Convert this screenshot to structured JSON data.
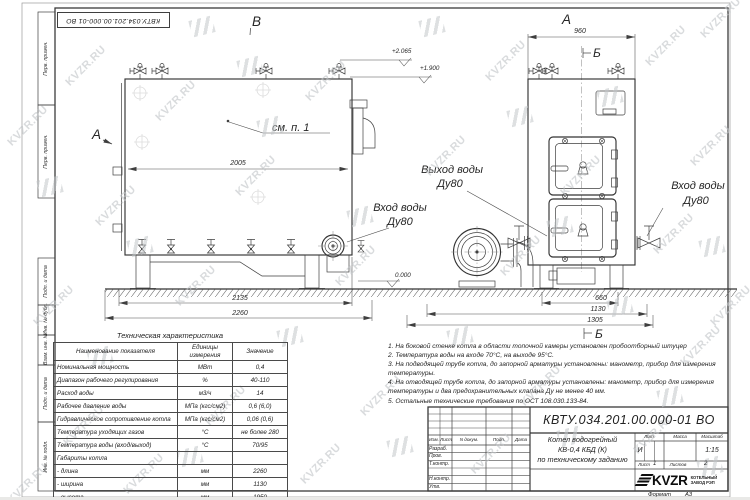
{
  "watermark": {
    "text": "KVZR.RU"
  },
  "frame": {
    "top_stamp": "КВТУ.034.201.00.000-01 ВО",
    "left_top_labels": [
      "Перв. примен.",
      "Перв. примен."
    ],
    "left_bottom_labels": [
      "Подп. и дата",
      "Инв. № дубл.",
      "Взам. инв. №",
      "Подп. и дата",
      "Инв. № подл."
    ],
    "format_label": "Формат",
    "format_value": "А3"
  },
  "drawing": {
    "markers": {
      "a_left": "А",
      "b_top": "В",
      "a_front": "А",
      "b_front": "Б",
      "b_bottom": "Б"
    },
    "callout_note": "см. п. 1",
    "port_labels": {
      "outlet_line1": "Выход воды",
      "outlet_line2": "Ду80",
      "inlet_side_line1": "Вход воды",
      "inlet_side_line2": "Ду80",
      "inlet_front_line1": "Вход воды",
      "inlet_front_line2": "Ду80"
    },
    "elevations": {
      "valve_top": "+2.065",
      "boiler_top": "+1.900",
      "ground": "0.000"
    },
    "dimensions": {
      "body_length": "2005",
      "support_span": "2135",
      "overall_length": "2260",
      "front_width": "960",
      "door_span": "660",
      "width": "1130",
      "overall_width": "1305"
    }
  },
  "spec_table": {
    "title": "Техническая характеристика",
    "headers": [
      "Наименование показателя",
      "Единицы измерения",
      "Значение"
    ],
    "rows": [
      [
        "Номинальная мощность",
        "МВт",
        "0,4"
      ],
      [
        "Диапазон рабочего регулирования",
        "%",
        "40-110"
      ],
      [
        "Расход воды",
        "м3/ч",
        "14"
      ],
      [
        "Рабочее давление воды",
        "МПа (кгс/см2)",
        "0,6 (6,0)"
      ],
      [
        "Гидравлическое сопротивление котла",
        "МПа (кгс/см2)",
        "0,06 (0,6)"
      ],
      [
        "Температура уходящих газов",
        "°С",
        "не более 280"
      ],
      [
        "Температура воды (вход/выход)",
        "°С",
        "70/95"
      ],
      [
        "Габариты котла",
        "",
        ""
      ],
      [
        "- длина",
        "мм",
        "2260"
      ],
      [
        "- ширина",
        "мм",
        "1130"
      ],
      [
        "- высота",
        "мм",
        "1950"
      ]
    ]
  },
  "notes": [
    "1.  На боковой стенке котла в области топочной камеры установлен пробоотборный штуцер",
    "2.  Температура воды на входе 70°С, на выходе 95°С.",
    "3.  На подводящей трубе котла, до запорной арматуры установлены: манометр, прибор для измерения температуры.",
    "4.  На отводящей трубе котла, до запорной арматуры установлены: манометр, прибор для измерения температуры и два предохранительных клапана Ду не менее 40 мм.",
    "5.  Остальные технические требования по ОСТ 108.030.133-84."
  ],
  "title_block": {
    "doc_number": "КВТУ.034.201.00.000-01 ВО",
    "title_line1": "Котел водогрейный",
    "title_line2": "КВ-0,4 КБД (К)",
    "title_line3": "по техническому заданию",
    "rev_headers": [
      "Изм.",
      "Лист",
      "N докум.",
      "Подп.",
      "Дата"
    ],
    "row_labels": [
      "Разраб.",
      "Пров.",
      "Т.контр.",
      "Н.контр.",
      "Утв."
    ],
    "lit_header": "Лит.",
    "mass_header": "Масса",
    "scale_header": "Масштаб",
    "lit_value": "И",
    "scale_value": "1:15",
    "sheet_label": "Лист",
    "sheet_value": "1",
    "sheets_label": "Листов",
    "sheets_value": "2",
    "logo_text": "KVZR",
    "logo_sub1": "КОТЕЛЬНЫЙ",
    "logo_sub2": "ЗАВОД РЭП"
  }
}
